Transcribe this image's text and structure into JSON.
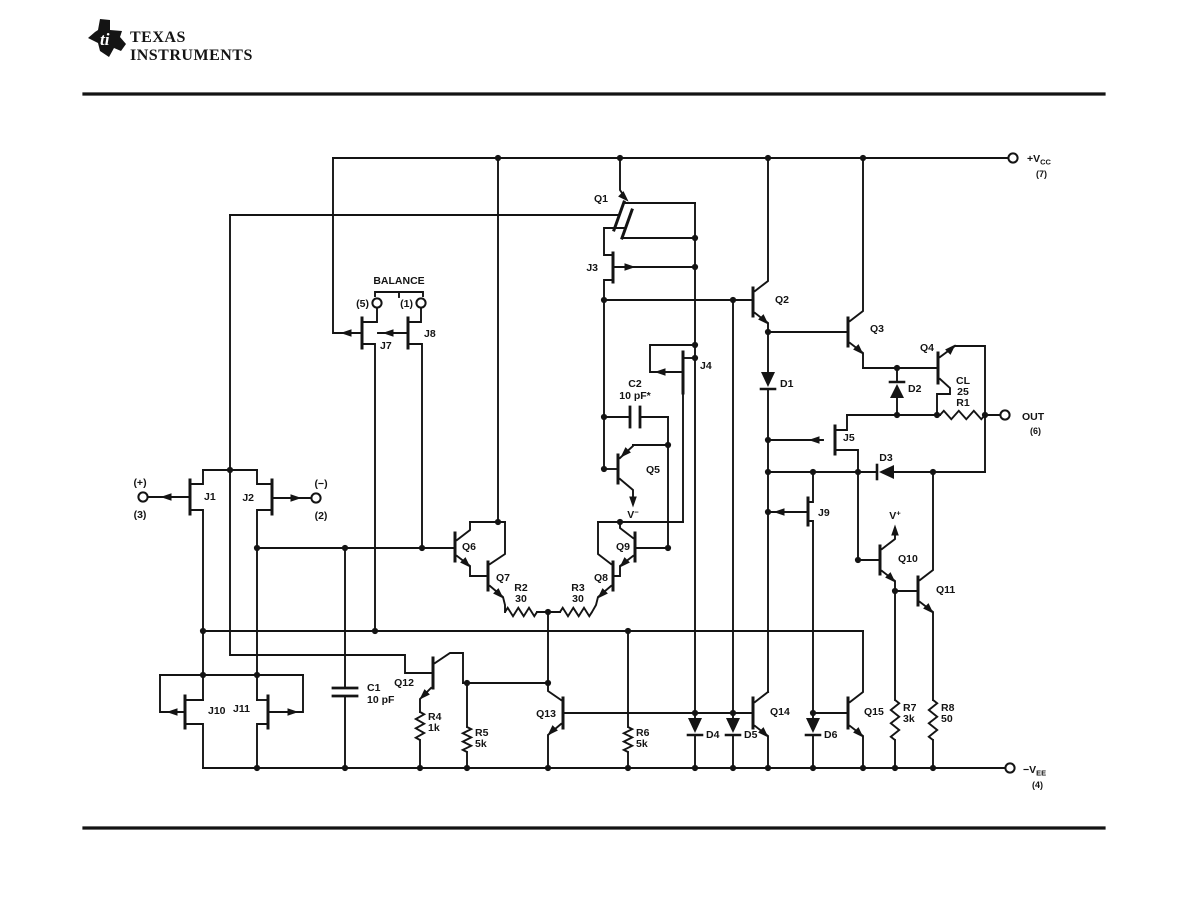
{
  "brand": {
    "line1": "TEXAS",
    "line2": "INSTRUMENTS",
    "monogram": "ti"
  },
  "labels": {
    "q1": "Q1",
    "q2": "Q2",
    "q3": "Q3",
    "q4": "Q4",
    "q5": "Q5",
    "q6": "Q6",
    "q7": "Q7",
    "q8": "Q8",
    "q9": "Q9",
    "q10": "Q10",
    "q11": "Q11",
    "q12": "Q12",
    "q13": "Q13",
    "q14": "Q14",
    "q15": "Q15",
    "j1": "J1",
    "j2": "J2",
    "j3": "J3",
    "j4": "J4",
    "j5": "J5",
    "j7": "J7",
    "j8": "J8",
    "j9": "J9",
    "j10": "J10",
    "j11": "J11",
    "d1": "D1",
    "d2": "D2",
    "d3": "D3",
    "d4": "D4",
    "d5": "D5",
    "d6": "D6",
    "r1_note": "CL",
    "r1_value": "25",
    "r1_ref": "R1",
    "r2_ref": "R2",
    "r2_value": "30",
    "r3_ref": "R3",
    "r3_value": "30",
    "r4_ref": "R4",
    "r4_value": "1k",
    "r5_ref": "R5",
    "r5_value": "5k",
    "r6_ref": "R6",
    "r6_value": "5k",
    "r7_ref": "R7",
    "r7_value": "3k",
    "r8_ref": "R8",
    "r8_value": "50",
    "c1_ref": "C1",
    "c1_value": "10 pF",
    "c2_ref": "C2",
    "c2_value": "10 pF*",
    "balance": "BALANCE",
    "bal5": "(5)",
    "bal1": "(1)",
    "in_pos": "(+)",
    "in_pos_pin": "(3)",
    "in_neg": "(−)",
    "in_neg_pin": "(2)",
    "vcc_base": "+V",
    "vcc_sub": "CC",
    "vcc_pin": "(7)",
    "out": "OUT",
    "out_pin": "(6)",
    "vee_base": "−V",
    "vee_sub": "EE",
    "vee_pin": "(4)",
    "vminus_base": "V",
    "vminus_sup": "−",
    "vplus_base": "V",
    "vplus_sup": "+"
  },
  "colors": {
    "ink": "#141414",
    "paper": "#ffffff"
  }
}
